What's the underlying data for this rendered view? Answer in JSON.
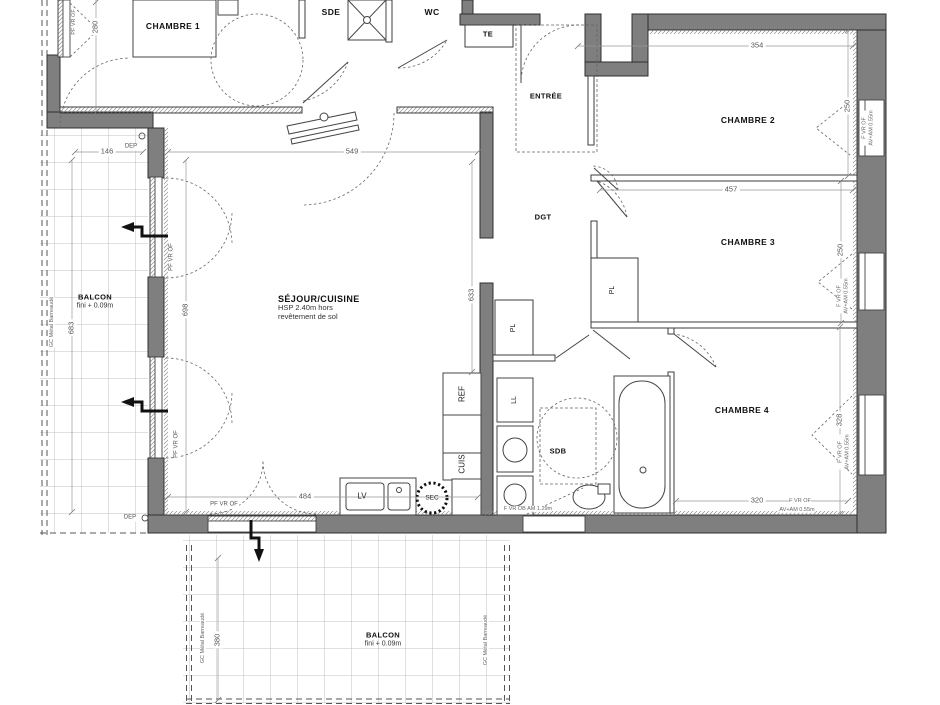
{
  "colors": {
    "wall": "#7f7f7f",
    "wall_stroke": "#2f2f2f",
    "line": "#444444",
    "dim_text": "#555555",
    "balcony_grid": "#bcc6bf"
  },
  "rooms": {
    "chambre1": "CHAMBRE 1",
    "sde": "SDE",
    "wc": "WC",
    "te": "TE",
    "entree": "ENTRÉE",
    "chambre2": "CHAMBRE 2",
    "chambre3": "CHAMBRE 3",
    "chambre4": "CHAMBRE 4",
    "sejour": "SÉJOUR/CUISINE",
    "sejour_sub1": "HSP 2.40m hors",
    "sejour_sub2": "revêtement de sol",
    "dgt": "DGT",
    "sdb": "SDB",
    "balcon": "BALCON",
    "balcon_sub": "fini + 0.09m"
  },
  "fixtures": {
    "pl": "PL",
    "ll": "LL",
    "ref": "REF",
    "cuis": "CUIS",
    "lv": "LV",
    "sec": "SEC",
    "dep": "DEP"
  },
  "dimensions": {
    "d280": "280",
    "d146": "146",
    "d549": "549",
    "d354": "354",
    "d457": "457",
    "d250_chambre2": "250",
    "d250_chambre3": "250",
    "d328": "328",
    "d320": "320",
    "d698": "698",
    "d633": "633",
    "d484": "484",
    "d683": "683",
    "d380": "380"
  },
  "annotations": {
    "window_f": "F VR OF",
    "window_av": "AV+AM 0.55m",
    "window_pf": "PF VR OF",
    "window_sdb": "F VR OB AM 1.29m",
    "railing": "GC Métal Barreaudé"
  }
}
